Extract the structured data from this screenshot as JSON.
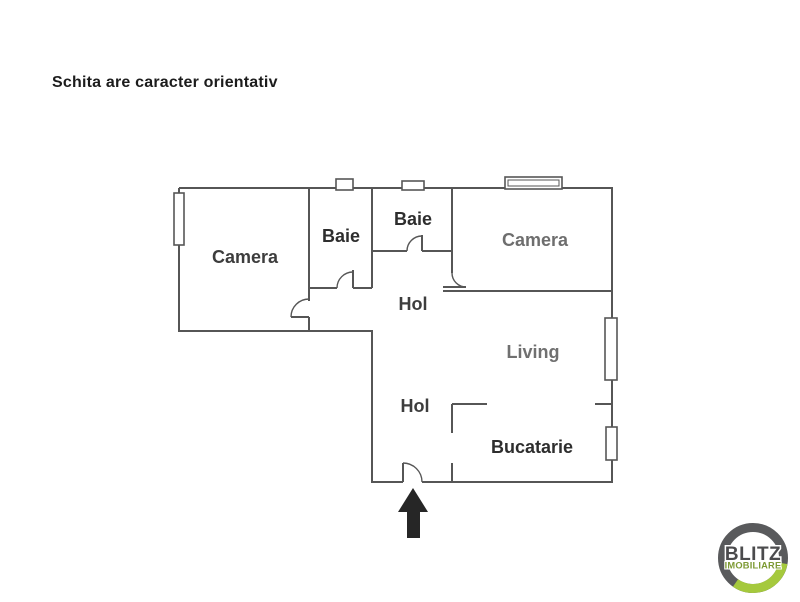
{
  "title": "Schita are caracter orientativ",
  "plan": {
    "rooms": [
      {
        "id": "camera-left",
        "label": "Camera",
        "color": "#3d3d3d"
      },
      {
        "id": "baie-left",
        "label": "Baie",
        "color": "#2e2e2e"
      },
      {
        "id": "baie-middle",
        "label": "Baie",
        "color": "#2e2e2e"
      },
      {
        "id": "camera-right",
        "label": "Camera",
        "color": "#6e6e6e"
      },
      {
        "id": "hol-upper",
        "label": "Hol",
        "color": "#3d3d3d"
      },
      {
        "id": "living",
        "label": "Living",
        "color": "#707070"
      },
      {
        "id": "hol-lower",
        "label": "Hol",
        "color": "#3d3d3d"
      },
      {
        "id": "bucatarie",
        "label": "Bucatarie",
        "color": "#2e2e2e"
      }
    ],
    "symbols": {
      "entrance_arrow": "up-arrow-icon",
      "door": "door-swing-icon",
      "window": "window-icon"
    }
  },
  "logo": {
    "brand": "BLITZ",
    "tagline": "IMOBILIARE",
    "ring_gray": "#595a5c",
    "accent_green": "#a5c93d",
    "brand_text_color": "#4b4b4d",
    "tagline_text_color": "#7d9a33"
  },
  "colors": {
    "wall": "#565656",
    "arrow": "#262626",
    "background": "#ffffff"
  }
}
